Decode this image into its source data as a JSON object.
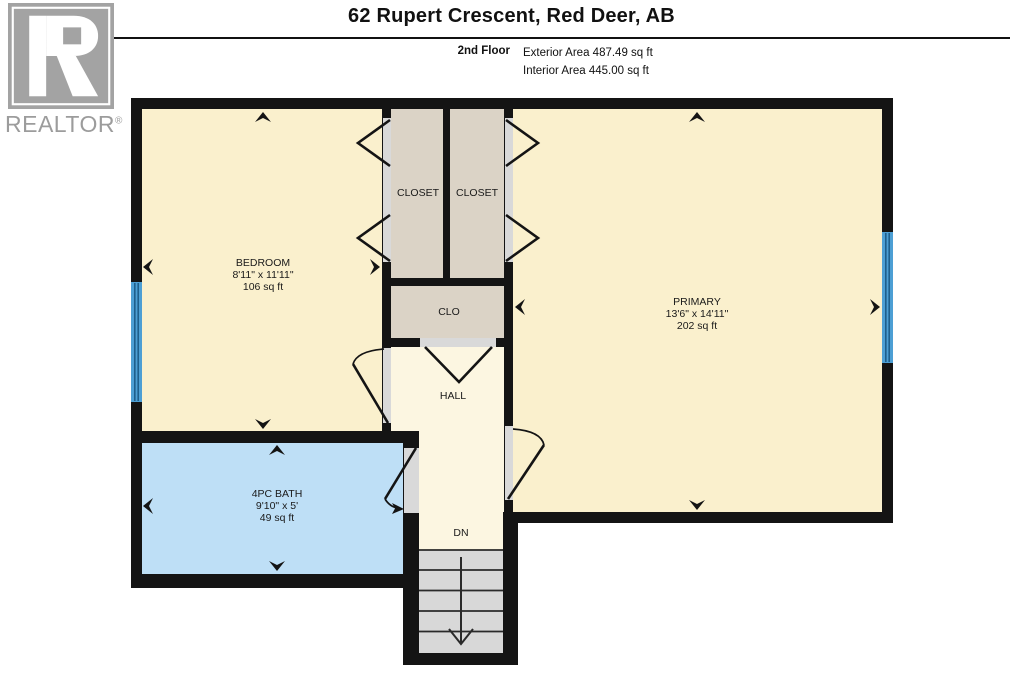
{
  "header": {
    "title": "62 Rupert Crescent, Red Deer, AB",
    "floor_label": "2nd Floor",
    "exterior_area": "Exterior Area 487.49 sq ft",
    "interior_area": "Interior Area 445.00 sq ft"
  },
  "logo": {
    "brand": "REALTOR",
    "registered": "®"
  },
  "rooms": {
    "bedroom": {
      "name": "BEDROOM",
      "dimensions": "8'11\" x 11'11\"",
      "area": "106 sq ft"
    },
    "primary": {
      "name": "PRIMARY",
      "dimensions": "13'6\" x 14'11\"",
      "area": "202 sq ft"
    },
    "bath": {
      "name": "4PC BATH",
      "dimensions": "9'10\" x 5'",
      "area": "49 sq ft"
    },
    "closet_left": {
      "name": "CLOSET"
    },
    "closet_right": {
      "name": "CLOSET"
    },
    "clo": {
      "name": "CLO"
    },
    "hall": {
      "name": "HALL"
    },
    "stairs": {
      "label": "DN"
    }
  },
  "colors": {
    "wall": "#141414",
    "room_cream": "#FAF0CD",
    "hall_cream": "#FCF6E1",
    "closet_gray": "#DBD3C6",
    "bath_blue": "#BEDFF6",
    "opening_gray": "#D9D9D9",
    "stairs_gray": "#D8D8D8",
    "window_blue": "#4D9FD4",
    "logo_gray": "#A3A3A3"
  }
}
